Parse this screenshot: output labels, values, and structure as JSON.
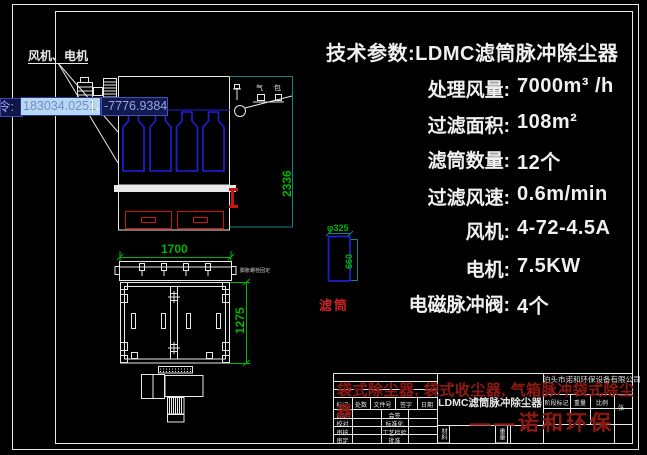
{
  "dynamic_input": {
    "prompt": "令:",
    "x_value": "183034.0251",
    "separator": ",",
    "y_value": "-7776.9384"
  },
  "front_view": {
    "callout": "风机、电机",
    "height_dim": "2336",
    "tank_char_1": "气",
    "tank_char_2": "包"
  },
  "plan_view": {
    "width_dim": "1700",
    "depth_dim": "1275",
    "note": "膨胀螺栓固定"
  },
  "cartridge_detail": {
    "dia_dim": "φ325",
    "length_dim": "660",
    "label": "滤筒"
  },
  "specs": {
    "title": "技术参数:LDMC滤筒脉冲除尘器",
    "rows": [
      {
        "label": "处理风量:",
        "value": "7000m³ /h"
      },
      {
        "label": "过滤面积:",
        "value": "108m²"
      },
      {
        "label": "滤筒数量:",
        "value": "12个"
      },
      {
        "label": "过滤风速:",
        "value": "0.6m/min"
      },
      {
        "label": "风机:",
        "value": "4-72-4.5A"
      },
      {
        "label": "电机:",
        "value": "7.5KW"
      },
      {
        "label": "电磁脉冲阀:",
        "value": "4个"
      }
    ]
  },
  "title_block": {
    "company": "泊头市诺和环保设备有限公司",
    "drawing_title": "LDMC滤筒脉冲除尘器",
    "rev_headers": [
      "标记",
      "处数",
      "文件号",
      "签字",
      "日期"
    ],
    "rows": [
      {
        "c1": "设计",
        "c2": "会签"
      },
      {
        "c1": "校对",
        "c2": "标准化"
      },
      {
        "c1": "审核",
        "c2": "工艺检验"
      },
      {
        "c1": "审定",
        "c2": "批准"
      }
    ],
    "material_label": "材料",
    "weight_label": "重量",
    "stage_header": "阶段标记",
    "weight_header": "重量",
    "scale_header": "比例",
    "sheet_label": "张"
  },
  "watermark": {
    "line1": "袋式除尘器, 袋式收尘器, 气箱脉冲袋式除尘器",
    "line2": "——诺和环保"
  },
  "colors": {
    "background": "#000000",
    "line_white": "#e8e8e8",
    "cad_blue": "#2020dd",
    "cad_red": "#cc1111",
    "dim_green": "#00b400",
    "dim_teal": "#0e8585",
    "watermark_red": "#8a1a12",
    "input_selected_bg": "#b7d7f3",
    "input_bg": "#131a50"
  }
}
